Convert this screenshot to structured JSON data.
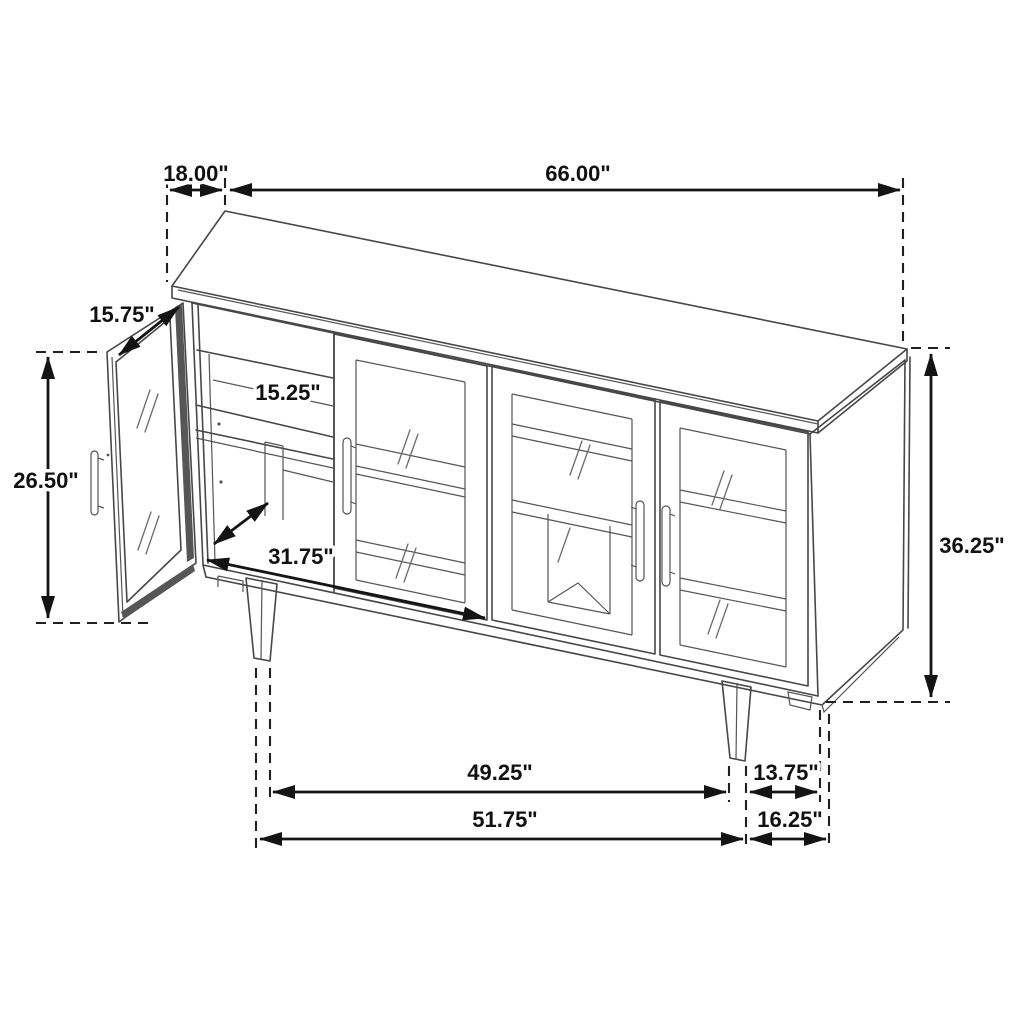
{
  "diagram": {
    "type": "furniture-dimension-line-drawing",
    "item": "sideboard-cabinet-with-glass-doors",
    "background_color": "#ffffff",
    "line_color": "#474747",
    "annotation_color": "#111111",
    "units": "inches"
  },
  "labels": {
    "top_depth": "18.00\"",
    "top_width": "66.00\"",
    "door_width": "15.75\"",
    "door_height": "26.50\"",
    "shelf_depth": "15.25\"",
    "interior_width": "31.75\"",
    "overall_height": "36.25\"",
    "legs_inner_span": "49.25\"",
    "legs_depth_inner": "13.75\"",
    "legs_outer_span": "51.75\"",
    "legs_depth_outer": "16.25\""
  }
}
